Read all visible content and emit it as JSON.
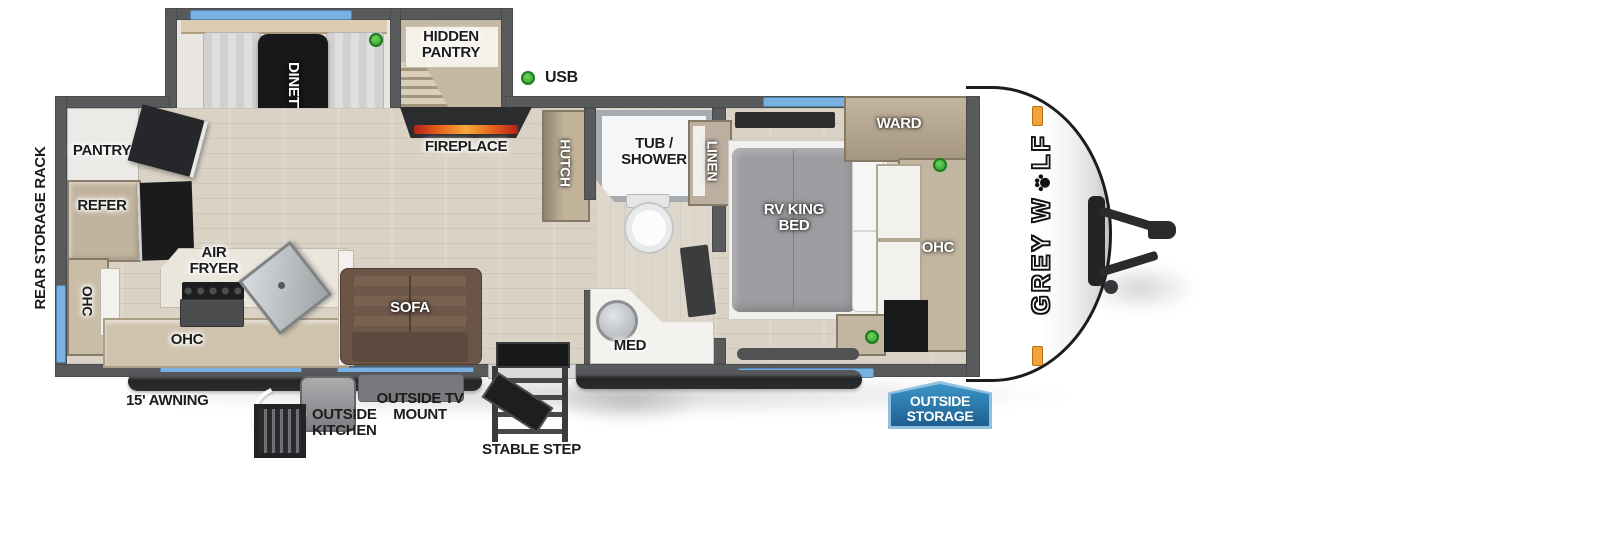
{
  "labels": {
    "rear_storage_rack": "REAR STORAGE RACK",
    "pantry": "PANTRY",
    "refer": "REFER",
    "ohc_rear": "OHC",
    "air_fryer": "AIR FRYER",
    "ohc_kitchen": "OHC",
    "dinette": "DINETTE",
    "hidden_pantry": "HIDDEN PANTRY",
    "usb": "USB",
    "fireplace": "FIREPLACE",
    "hutch": "HUTCH",
    "sofa": "SOFA",
    "tub_shower": "TUB / SHOWER",
    "med": "MED",
    "linen": "LINEN",
    "rv_king_bed": "RV KING BED",
    "ward": "WARD",
    "ohc_bedroom": "OHC",
    "awning": "15' AWNING",
    "outside_kitchen": "OUTSIDE KITCHEN",
    "outside_tv_mount": "OUTSIDE TV MOUNT",
    "stable_step": "STABLE STEP",
    "outside_storage": "OUTSIDE STORAGE",
    "brand_part1": "GREY W",
    "brand_part2": "LF"
  },
  "colors": {
    "window_blue": "#79b1e2",
    "marker_green": "#3fae3c",
    "badge_blue": "#2a7fb5",
    "clearance_orange": "#f2a43a",
    "wall_gray": "#595a5c"
  }
}
